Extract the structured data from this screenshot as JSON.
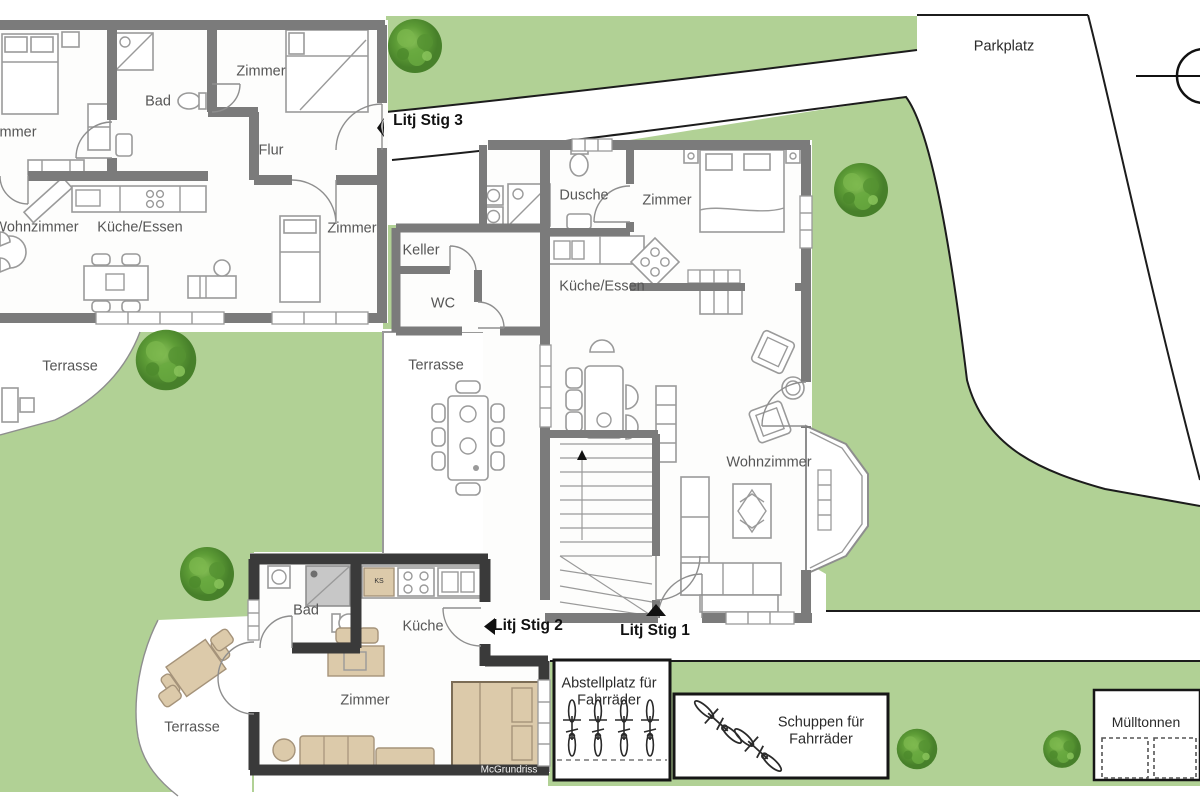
{
  "colors": {
    "lawn": "#b1d195",
    "wall": "#7b7b7b",
    "wall_dark": "#3a3a3a",
    "accent_beige": "#dccaaa"
  },
  "site": {
    "parkplatz": "Parkplatz",
    "abstellplatz": "Abstellplatz für Fahrräder",
    "schuppen": "Schuppen für Fahrräder",
    "muelltonnen": "Mülltonnen",
    "watermark": "McGrundriss"
  },
  "entrances": [
    {
      "label": "Litj Stig 1",
      "direction": "up"
    },
    {
      "label": "Litj Stig 2",
      "direction": "left"
    },
    {
      "label": "Litj Stig 3",
      "direction": "left"
    }
  ],
  "apartment_top_left": {
    "rooms": {
      "zimmer_a": "Zimmer",
      "bad": "Bad",
      "zimmer_b": "Zimmer",
      "flur": "Flur",
      "wohnzimmer": "Wohnzimmer",
      "kueche_essen": "Küche/Essen",
      "zimmer_c": "Zimmer",
      "terrasse": "Terrasse"
    }
  },
  "apartment_middle": {
    "rooms": {
      "dusche": "Dusche",
      "zimmer": "Zimmer",
      "keller": "Keller",
      "wc": "WC",
      "kueche_essen": "Küche/Essen",
      "terrasse": "Terrasse",
      "wohnzimmer": "Wohnzimmer"
    }
  },
  "apartment_studio": {
    "rooms": {
      "bad": "Bad",
      "kueche": "Küche",
      "zimmer": "Zimmer",
      "terrasse": "Terrasse"
    },
    "appliance_abbr": "KS"
  }
}
